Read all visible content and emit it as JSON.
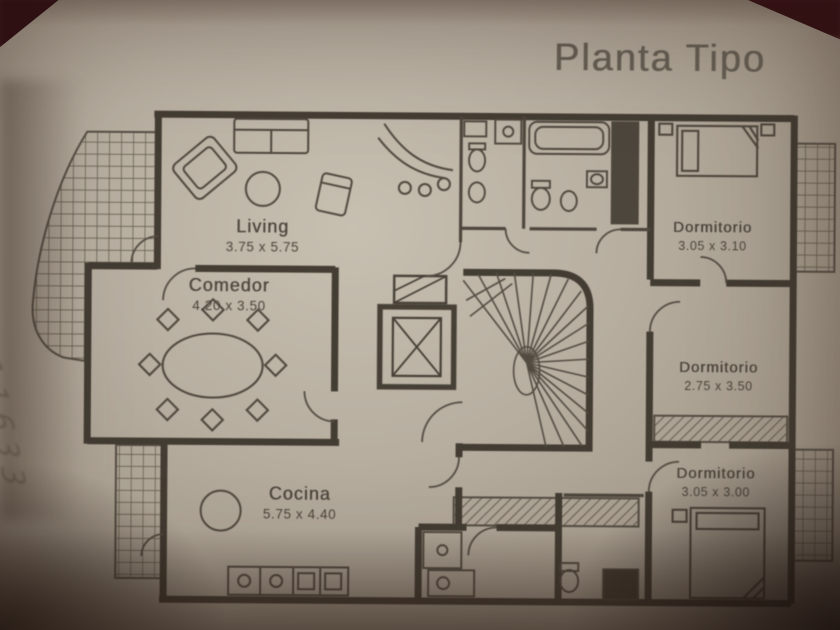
{
  "title": "Planta Tipo",
  "handwritten_note": "11633",
  "rooms": [
    {
      "name": "Living",
      "dims": "3.75 x 5.75"
    },
    {
      "name": "Comedor",
      "dims": "4.20 x 3.50"
    },
    {
      "name": "Cocina",
      "dims": "5.75 x 4.40"
    },
    {
      "name": "Dormitorio",
      "dims": "3.05 x 3.10"
    },
    {
      "name": "Dormitorio",
      "dims": "2.75 x 3.50"
    },
    {
      "name": "Dormitorio",
      "dims": "3.05 x 3.00"
    }
  ],
  "colors": {
    "paper": "#b7aea0",
    "ink": "#453e34",
    "background_corner": "#2e1012"
  }
}
